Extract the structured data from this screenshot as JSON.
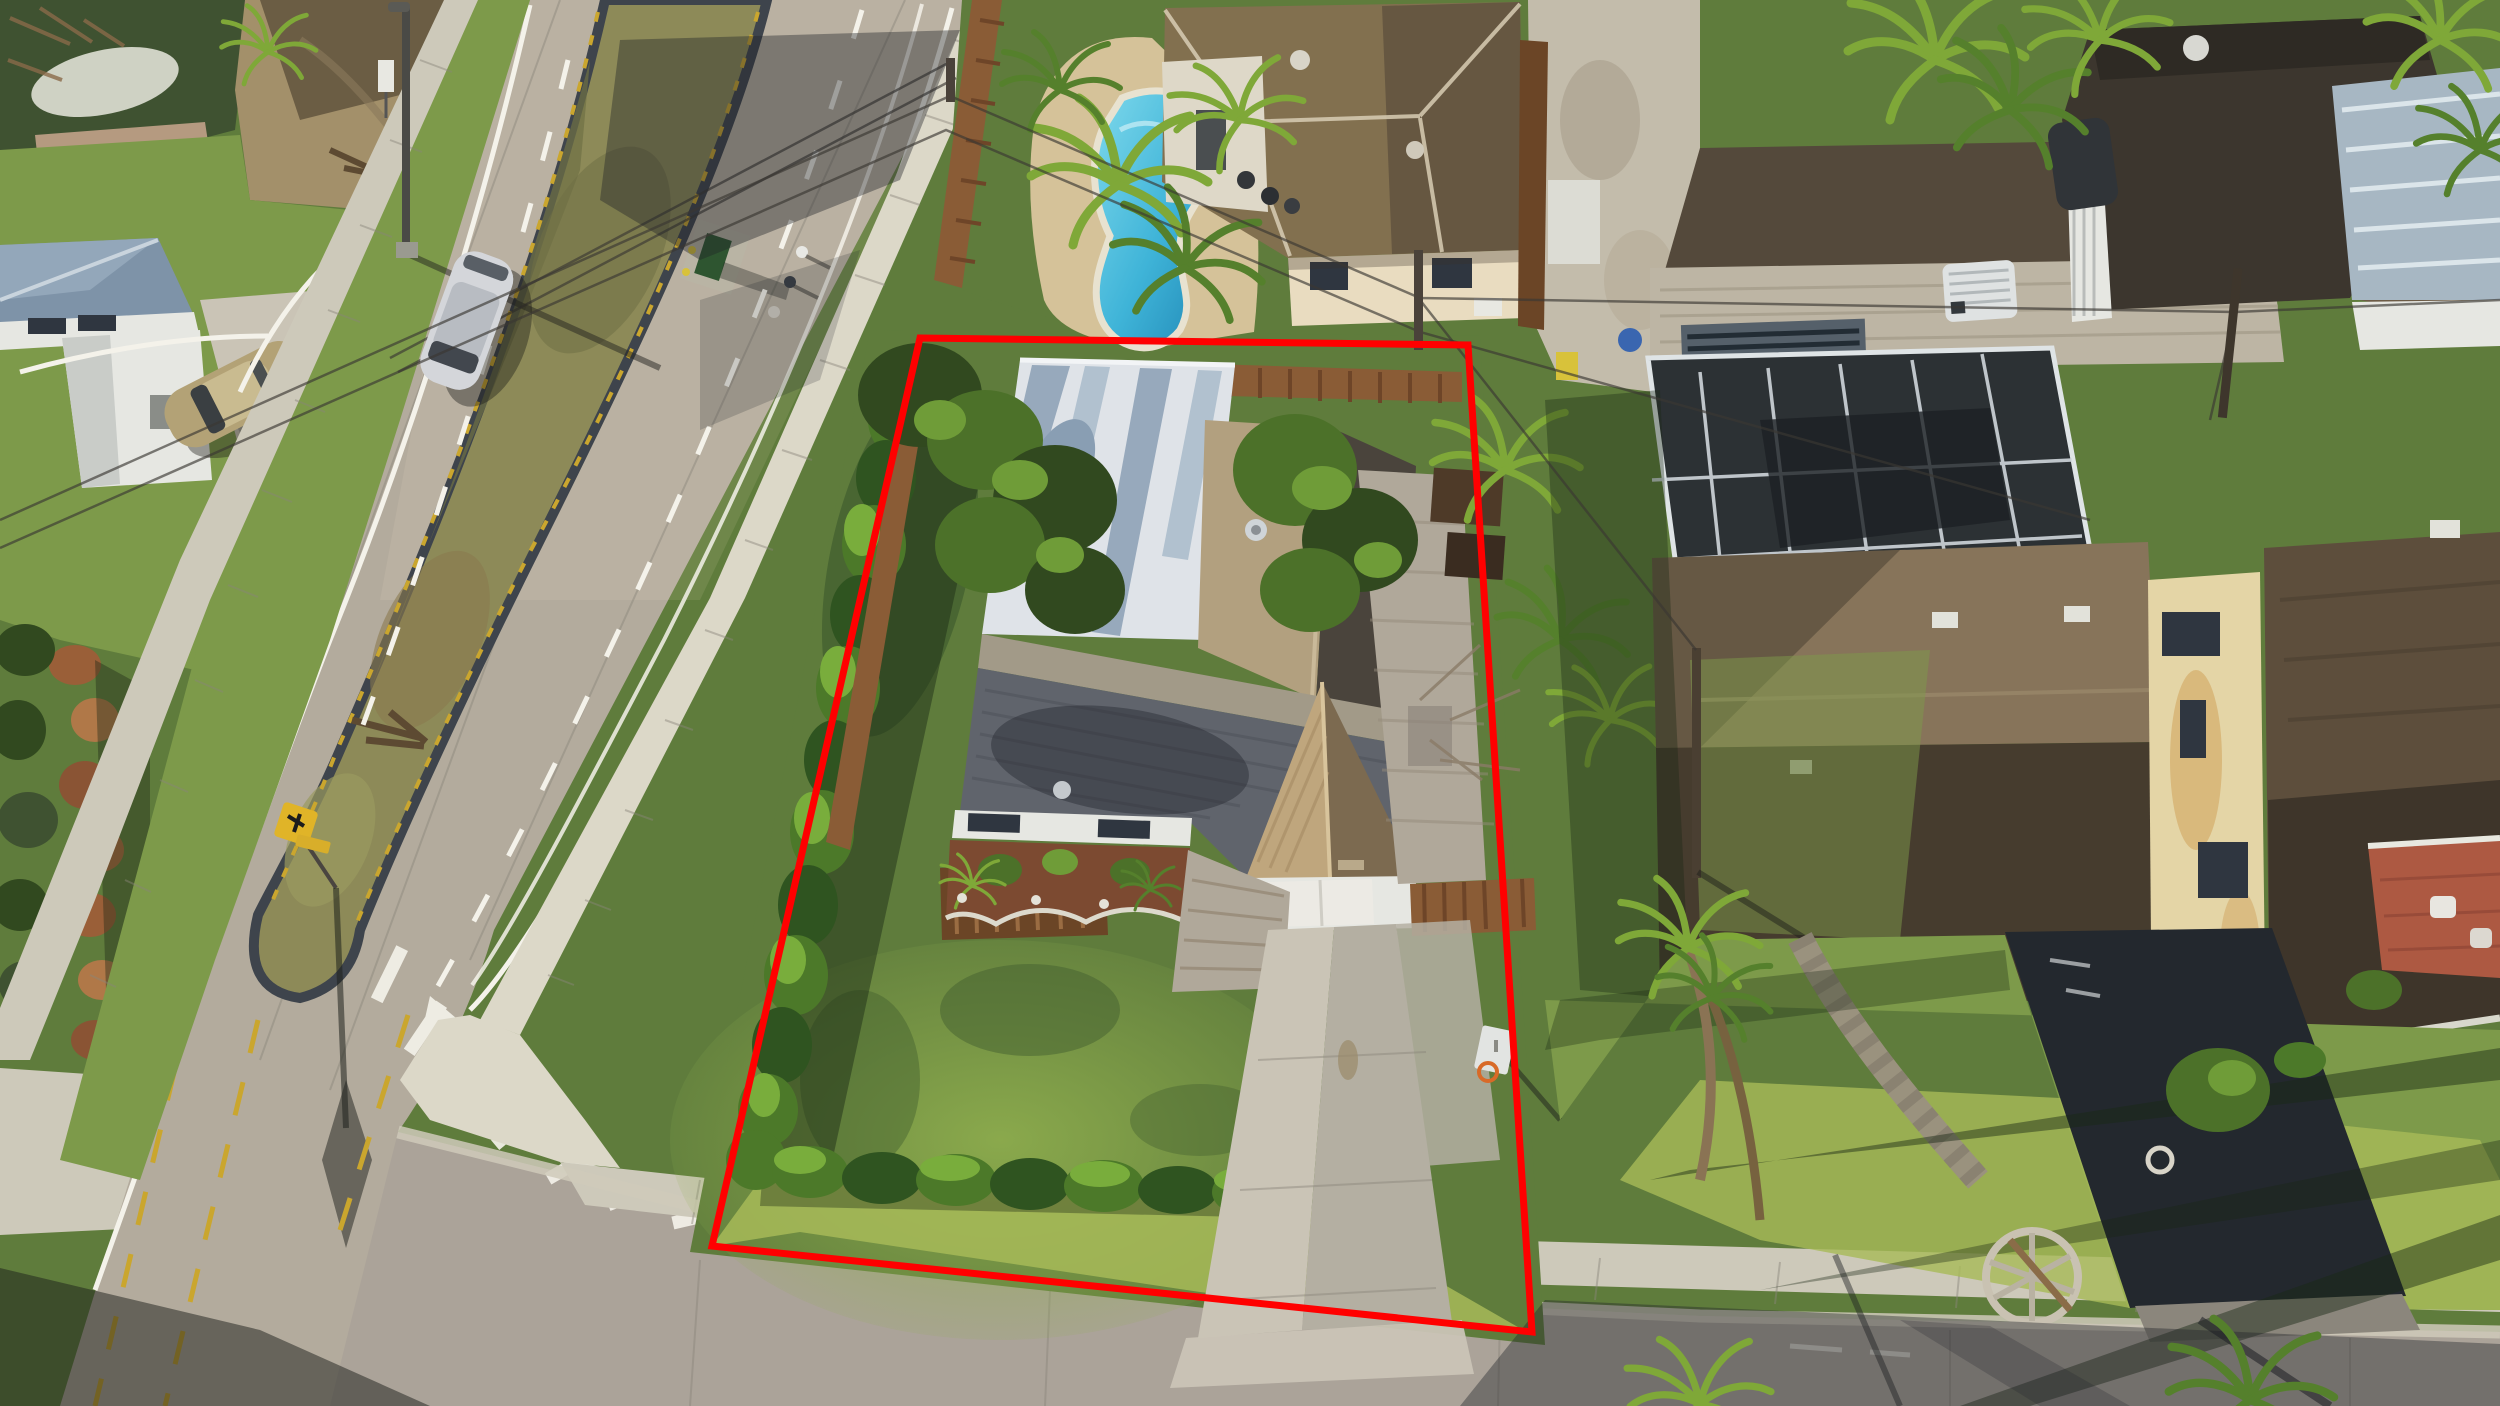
{
  "meta": {
    "title": "Aerial drone photograph of a corner residential lot with red property boundary outline",
    "type": "aerial-photograph",
    "description": "Golden-hour drone view of a single-family corner lot in a Florida-style neighborhood. A red polygon outlines the subject property: a house with gray and tan shingle roof, white flat carport roof, front garage gable, paver patio, concrete driveway to the street, L-shaped green hedge along the corner, and a large lawn. A divided road with a grass median runs along the left; a neighbor with a kidney-shaped pool sits above; neighbors with brown shingle roofs, a screened pool enclosure, a black asphalt driveway and long palm shadows sit to the right. A sidewalk and street cross the bottom."
  },
  "property_boundary": {
    "points": "920,338 1468,345 1532,1332 712,1246",
    "color": "#FF0000",
    "stroke_width": "7"
  },
  "palette": {
    "boundary_red": "#FF0000",
    "road_gray": "#b3ab9d",
    "street_gray": "#aba399",
    "sidewalk": "#cdc9ba",
    "median_grass": "#8d8a58",
    "lawn_green": "#5f7c3c",
    "sunlit_lawn": "#a7ba58",
    "hedge_green": "#4c7929",
    "carport_white": "#dfe3e8",
    "roof_slate": "#60646c",
    "roof_tan": "#b2a07f",
    "gable_shingle": "#bfa67d",
    "pool_blue": "#3fb4d8",
    "pool_deck": "#d5c299",
    "neighbor_roof_brown": "#87745a",
    "asphalt_black": "#23282e",
    "mulch_red": "#7c4a31",
    "sign_yellow": "#e0b428"
  },
  "scene": {
    "labels": [
      "divided-road-with-grass-median",
      "median-end-island",
      "pedestrian-warning-sign",
      "street-light-pole",
      "white-minivan-driving",
      "parked-tan-sedan",
      "white-house-top-left",
      "subject-lot-red-outline",
      "subject-house-gray-roof",
      "white-carport-roof",
      "garage-gable",
      "garage-door",
      "red-mulch-flower-beds",
      "paver-patio",
      "concrete-driveway",
      "basketball-hoop",
      "l-shaped-hedge",
      "kidney-pool-neighbor",
      "wood-privacy-fences",
      "screened-pool-enclosure",
      "two-story-yellow-wall-house",
      "metal-roof-house",
      "black-asphalt-driveway",
      "stone-wheel-ornament",
      "terracotta-patio",
      "corner-sidewalk-and-street",
      "crosswalk-chevron-markings",
      "power-lines-and-poles",
      "long-palm-shadows"
    ]
  }
}
